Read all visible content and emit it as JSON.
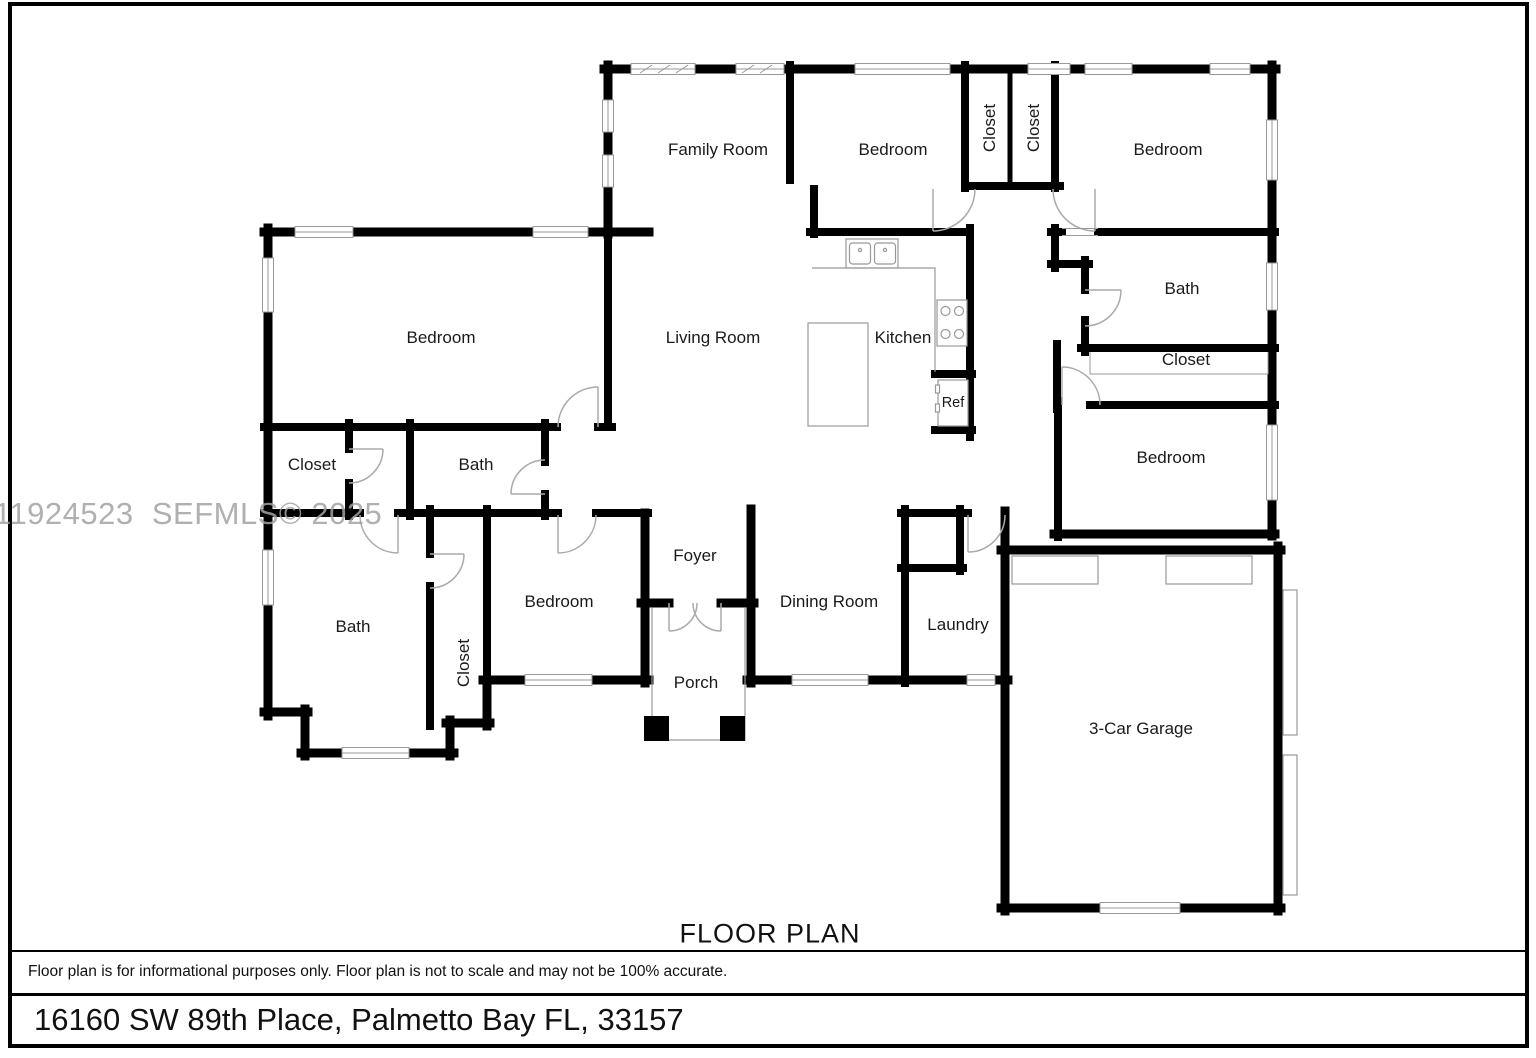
{
  "watermark": "11924523  SEFMLS© 2025",
  "plan_title": "FLOOR PLAN",
  "disclaimer": "Floor plan is for informational purposes only. Floor plan is not to scale and may not be 100% accurate.",
  "address": "16160 SW 89th Place, Palmetto Bay FL, 33157",
  "colors": {
    "wall": "#000000",
    "thin_line": "#999999",
    "watermark": "#a3a3a3"
  },
  "rooms": [
    {
      "id": "family-room",
      "label": "Family Room"
    },
    {
      "id": "bedroom-top-middle",
      "label": "Bedroom"
    },
    {
      "id": "closet-top-left",
      "label": "Closet"
    },
    {
      "id": "closet-top-right",
      "label": "Closet"
    },
    {
      "id": "bedroom-top-right",
      "label": "Bedroom"
    },
    {
      "id": "bedroom-left",
      "label": "Bedroom"
    },
    {
      "id": "living-room",
      "label": "Living Room"
    },
    {
      "id": "kitchen",
      "label": "Kitchen"
    },
    {
      "id": "refrigerator",
      "label": "Ref"
    },
    {
      "id": "bath-right",
      "label": "Bath"
    },
    {
      "id": "closet-right",
      "label": "Closet"
    },
    {
      "id": "bedroom-right-lower",
      "label": "Bedroom"
    },
    {
      "id": "closet-middle-left",
      "label": "Closet"
    },
    {
      "id": "bath-middle",
      "label": "Bath"
    },
    {
      "id": "bath-lower-left",
      "label": "Bath"
    },
    {
      "id": "closet-lower",
      "label": "Closet"
    },
    {
      "id": "bedroom-lower",
      "label": "Bedroom"
    },
    {
      "id": "foyer",
      "label": "Foyer"
    },
    {
      "id": "porch",
      "label": "Porch"
    },
    {
      "id": "dining-room",
      "label": "Dining Room"
    },
    {
      "id": "laundry",
      "label": "Laundry"
    },
    {
      "id": "garage",
      "label": "3-Car Garage"
    }
  ]
}
